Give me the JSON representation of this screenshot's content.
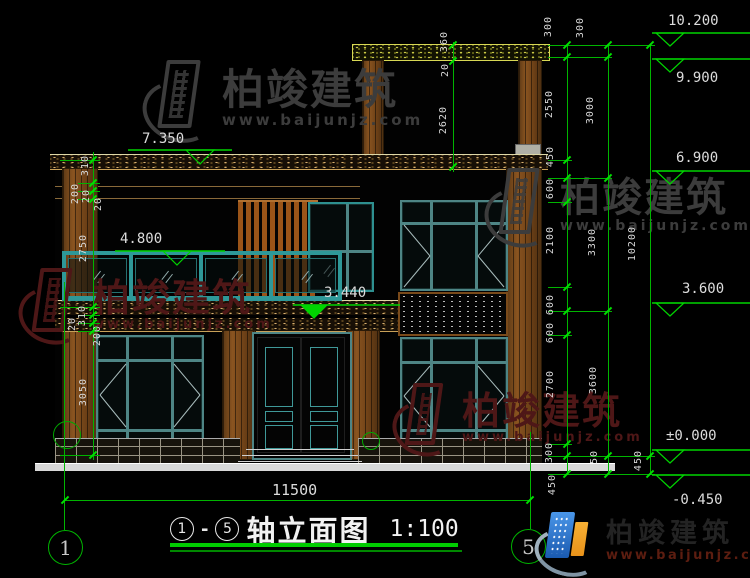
{
  "drawing": {
    "name": "轴立面图",
    "scale": "1:100",
    "axis_start": "1",
    "axis_end": "5",
    "dash": "-",
    "bottom_dim": "11500",
    "bubble_left": "1",
    "bubble_right": "5"
  },
  "elevations": {
    "e10200": "10.200",
    "e9900": "9.900",
    "e6900": "6.900",
    "e3600": "3.600",
    "e0": "±0.000",
    "em450": "-0.450",
    "e7350": "7.350",
    "e4800": "4.800",
    "e3440": "3.440"
  },
  "dims": {
    "right_a": [
      "300",
      "2550",
      "450",
      "600",
      "2100",
      "600",
      "600",
      "2700",
      "300",
      "450"
    ],
    "right_b": [
      "300",
      "3000",
      "3300",
      "3600",
      "450"
    ],
    "right_c": [
      "10200",
      "450"
    ],
    "left": [
      "310",
      "200",
      "20",
      "20",
      "2750",
      "310",
      "20",
      "200",
      "3050"
    ],
    "top": [
      "360",
      "20",
      "2620"
    ]
  },
  "watermark": {
    "brand": "柏竣建筑",
    "url": "www.baijunjz.com"
  },
  "colors": {
    "dim_green": "#00d400",
    "dim_text": "#d8d8d8",
    "window_teal": "#2e8b8b",
    "wood_brown": "#8a4f1d",
    "watermark_red": "#4e1717",
    "watermark_gray": "#3c3c3c",
    "logo_blue": "#2a72c8",
    "logo_orange": "#f0a125",
    "title_underline_green": "#00c800"
  }
}
